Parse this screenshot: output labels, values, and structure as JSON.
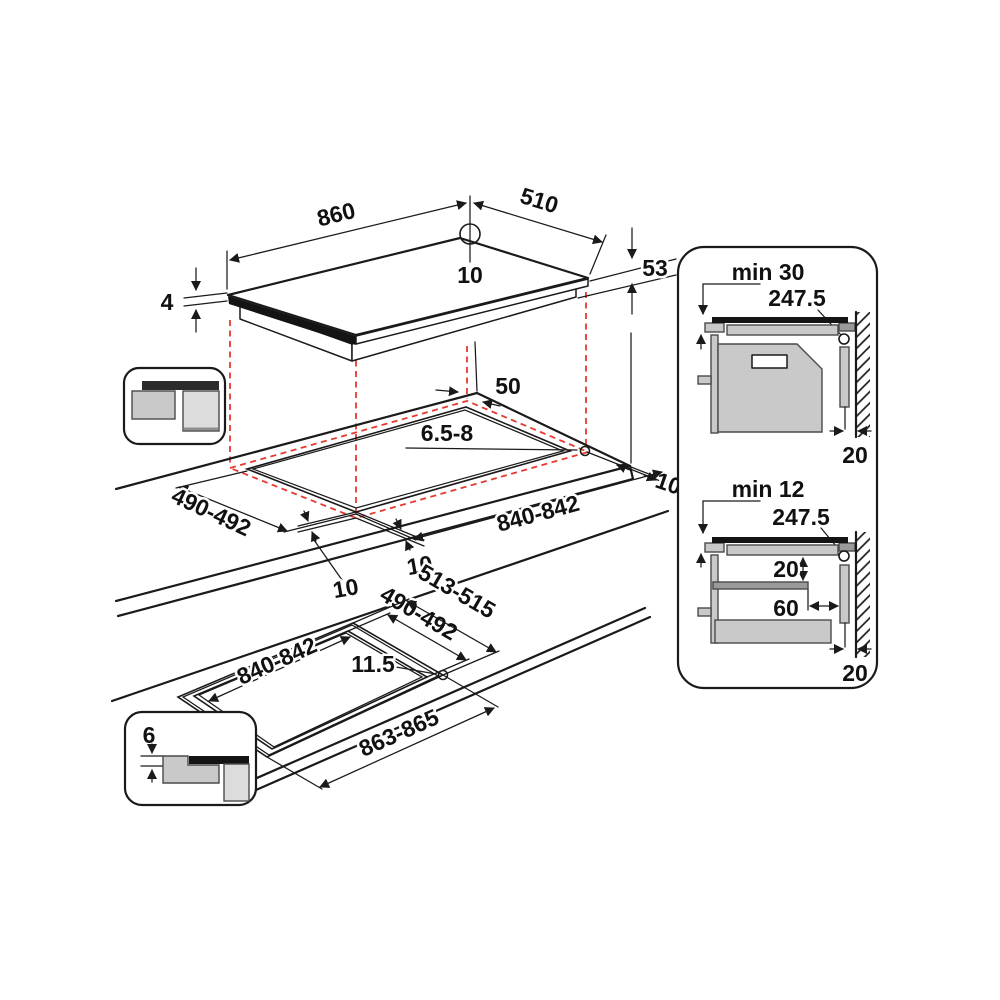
{
  "colors": {
    "line": "#1a1a1a",
    "projection_red": "#e8392f",
    "gray_light": "#dcdcdc",
    "gray_mid": "#c9c9c9",
    "gray_dark": "#2b2b2b"
  },
  "top_view": {
    "length": "860",
    "width": "510",
    "hole_offset": "10",
    "installed_height": "53",
    "glass_thickness": "4"
  },
  "cutout_view": {
    "rear_clearance": "50",
    "corner_radius": "6.5-8",
    "side_clearance": "100",
    "cutout_width": "490-492",
    "cutout_length": "840-842",
    "overhang_side": "10",
    "overhang_front": "10"
  },
  "flush_view": {
    "rebate_width": "513-515",
    "cutout_width": "490-492",
    "cutout_length": "840-842",
    "ledge_width": "11.5",
    "rebate_length": "863-865"
  },
  "flush_detail": {
    "rebate_depth": "6"
  },
  "clearance_panel": {
    "top": {
      "title": "min 30",
      "duct_dim": "247.5",
      "wall_gap": "20"
    },
    "bottom": {
      "title": "min 12",
      "duct_dim": "247.5",
      "drawer_clearance": "20",
      "shelf_setback": "60",
      "wall_gap": "20"
    }
  }
}
